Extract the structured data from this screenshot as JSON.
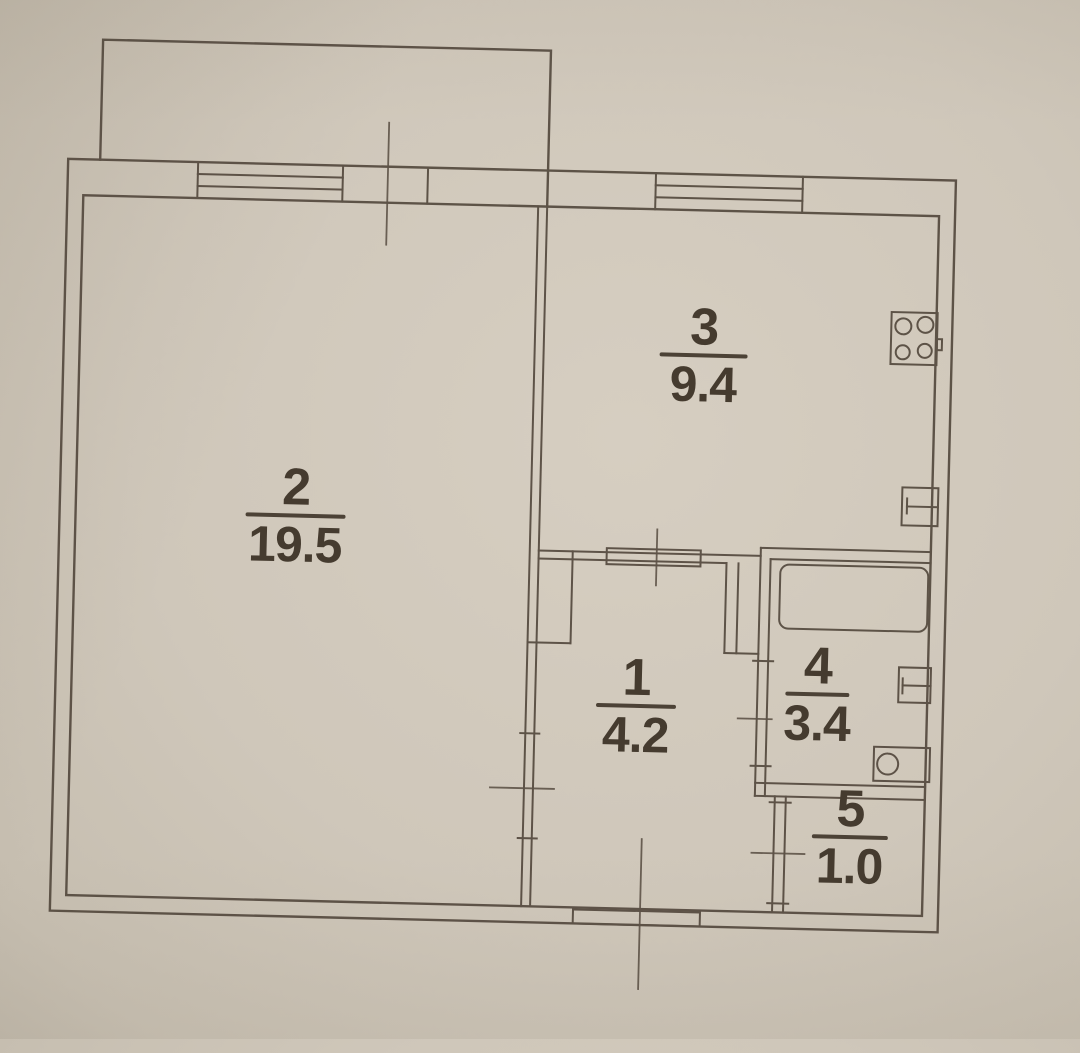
{
  "plan": {
    "rooms": [
      {
        "number": "2",
        "area": "19.5"
      },
      {
        "number": "3",
        "area": "9.4"
      },
      {
        "number": "1",
        "area": "4.2"
      },
      {
        "number": "4",
        "area": "3.4"
      },
      {
        "number": "5",
        "area": "1.0"
      }
    ],
    "fixtures": {
      "kitchen": [
        "stove-icon",
        "kitchen-sink-icon"
      ],
      "bathroom": [
        "bathtub-icon",
        "sink-icon",
        "washbasin-icon"
      ]
    },
    "symbols": [
      "window-icon",
      "door-opening-icon",
      "dimension-axis-line"
    ],
    "colors": {
      "paper": "#cfc7ba",
      "ink": "#54493e",
      "text": "#453b2f"
    }
  }
}
